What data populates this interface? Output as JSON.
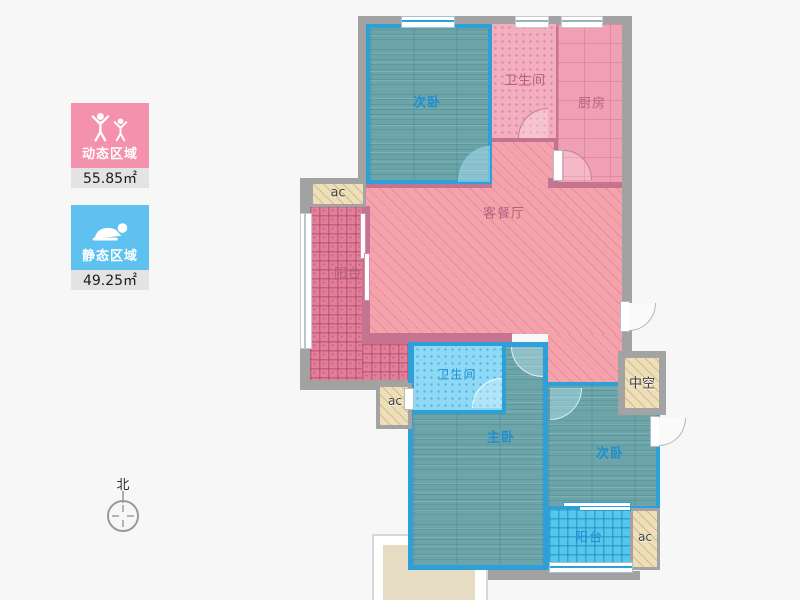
{
  "legend": {
    "dynamic": {
      "label": "动态区域",
      "area": "55.85㎡",
      "color": "#f491ad"
    },
    "static": {
      "label": "静态区域",
      "area": "49.25㎡",
      "color": "#5ec1f0"
    }
  },
  "compass": {
    "north_label": "北"
  },
  "plan": {
    "bedroom_top": "次卧",
    "bathroom_top": "卫生间",
    "kitchen": "厨房",
    "living_dining": "客餐厅",
    "balcony_left": "阳台",
    "ac_top": "ac",
    "ac_mid": "ac",
    "bathroom_low": "卫生间",
    "master_bedroom": "主卧",
    "bedroom_low": "次卧",
    "void_space": "中空",
    "balcony_low": "阳台",
    "ac_low": "ac"
  },
  "colors": {
    "dynamic_zone": "#f491ad",
    "static_zone": "#5ec1f0",
    "blue_room_border": "#2da0d8",
    "pink_wall": "#c4748e",
    "outer_wall": "#a2a2a2",
    "ac_fill": "#eedfb9"
  }
}
